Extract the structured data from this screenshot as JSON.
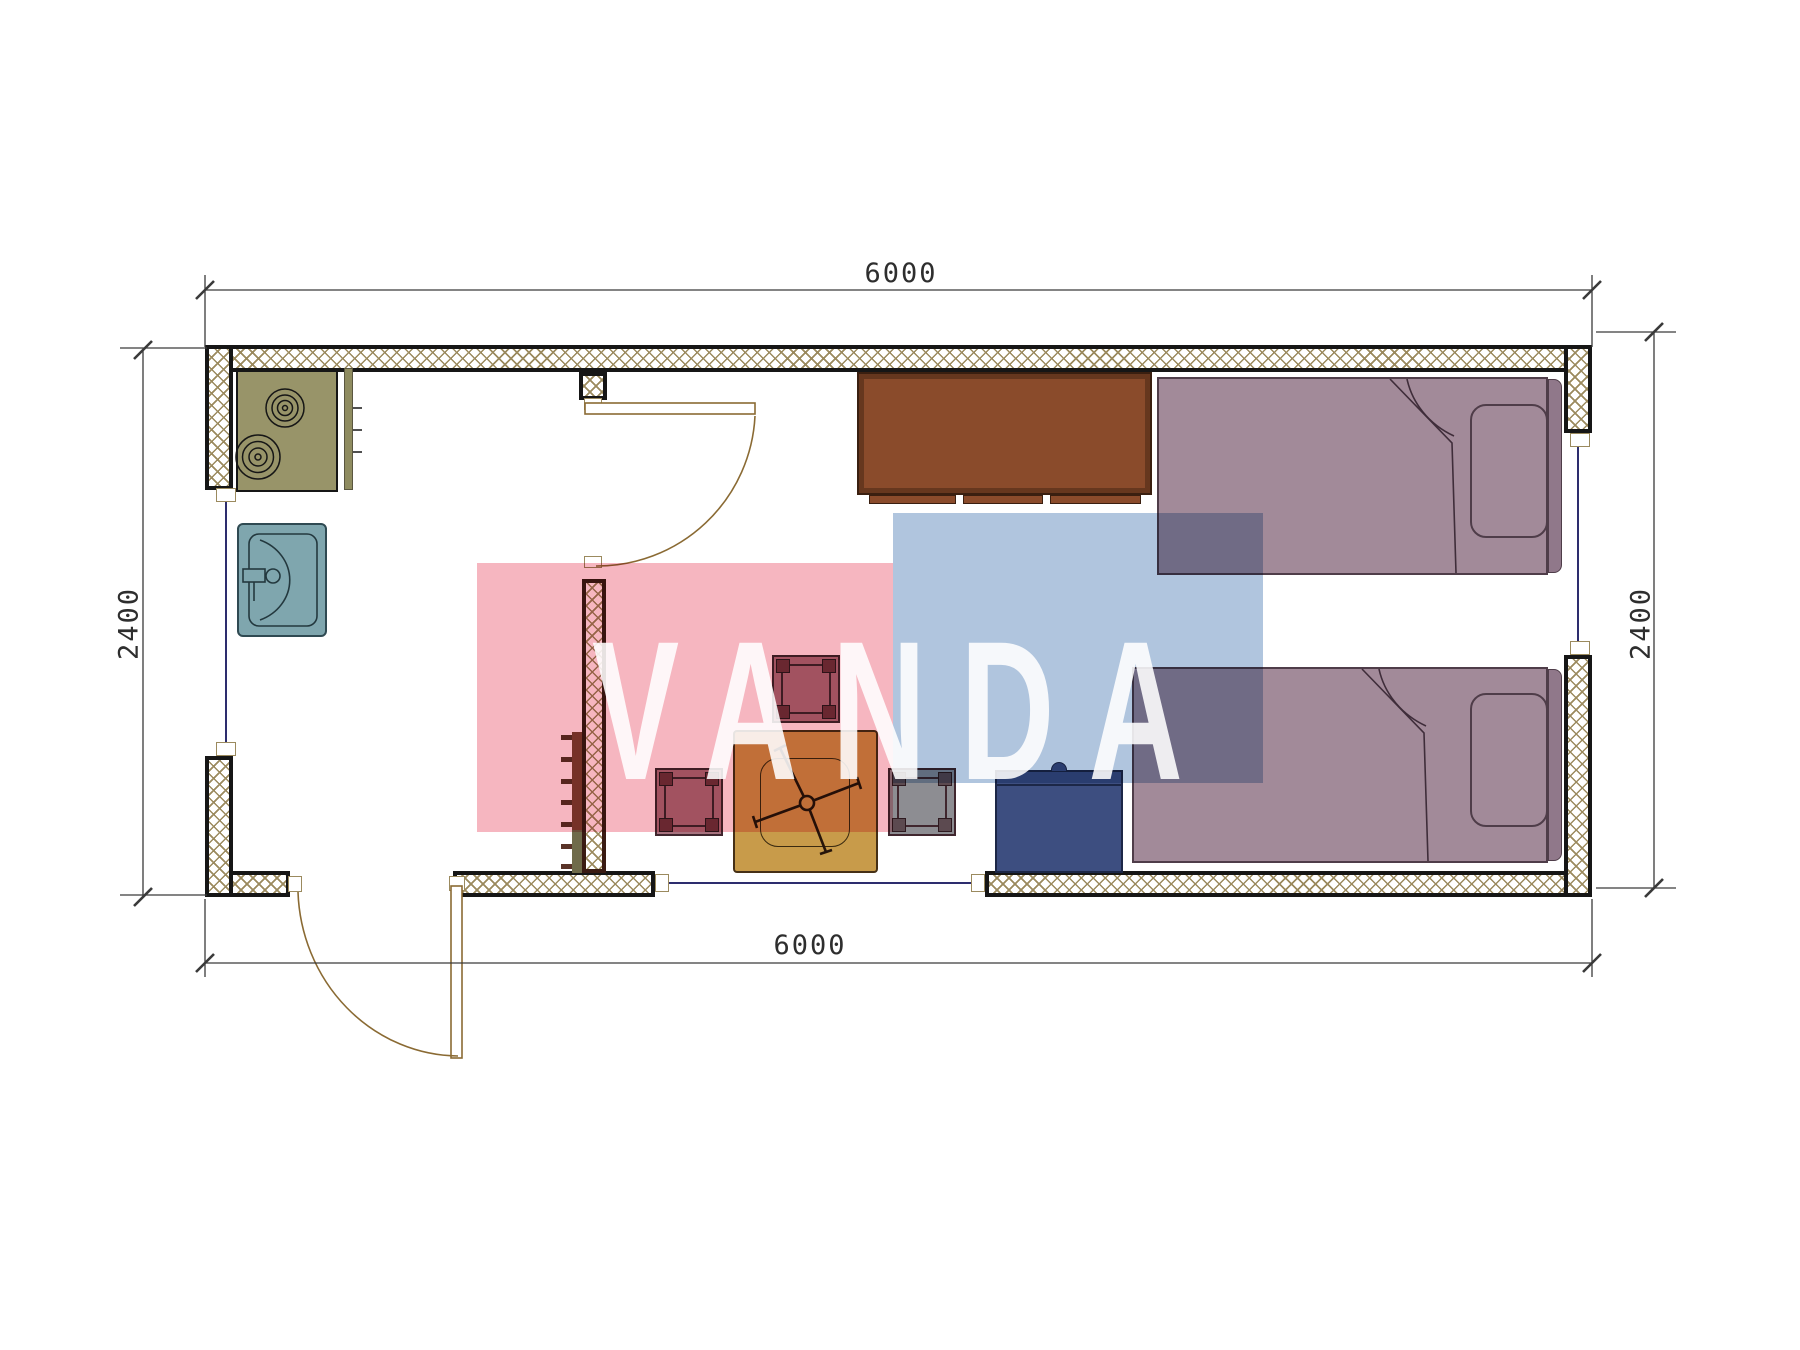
{
  "drawing": {
    "type": "floor-plan",
    "dimensions": {
      "top": "6000",
      "bottom": "6000",
      "left": "2400",
      "right": "2400"
    },
    "watermark": {
      "text": "VANDA",
      "pink_color": "#f6b6c0",
      "blue_color": "#b0c5de"
    },
    "colors": {
      "wall_hatch": "#9b8a5e",
      "wall_outline": "#161616",
      "stove": "#989469",
      "sink": "#7fa6ae",
      "desk": "#8a4b2b",
      "bed": "#a28a99",
      "table": "#c89b4a",
      "stool_mauve": "#a8737f",
      "stool_gray": "#8d8d92",
      "cabinet": "#3d4e80",
      "door_line": "#8a6a33"
    }
  }
}
